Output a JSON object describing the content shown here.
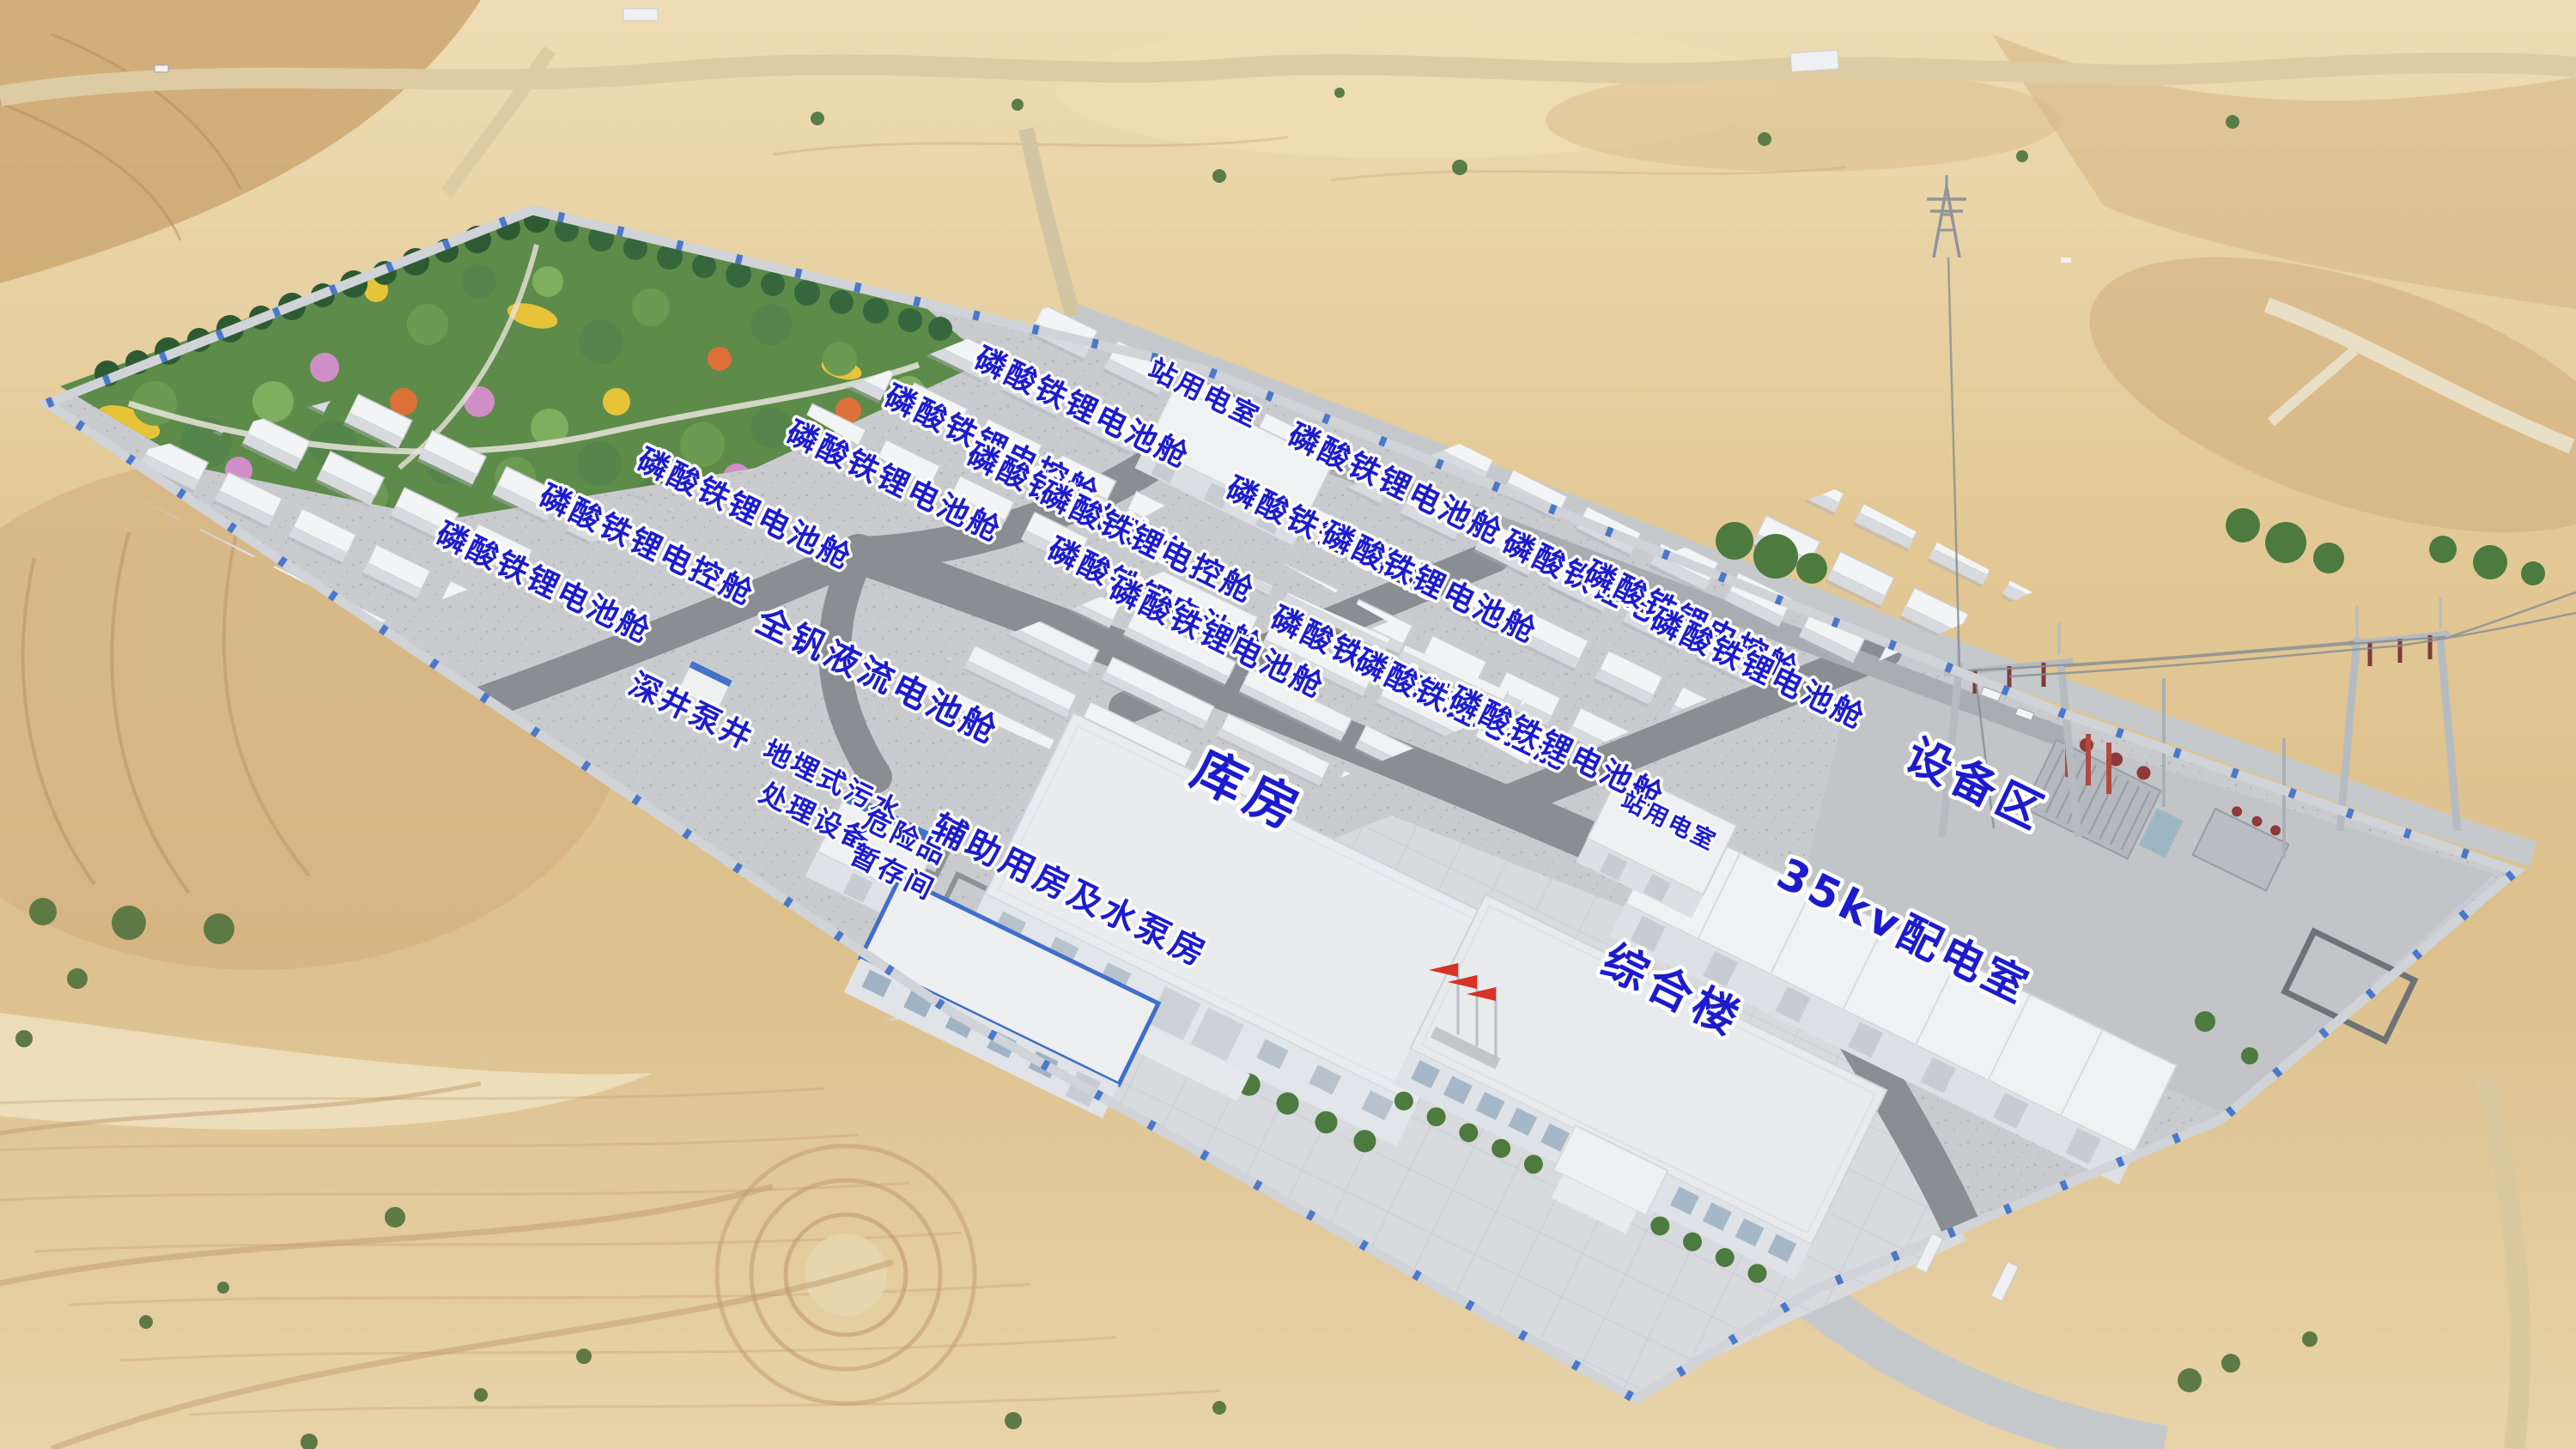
{
  "palette": {
    "label_blue": "#1c1ccd",
    "wall_blue": "#4273c9",
    "flag_red": "#d63226",
    "container_white": "#f3f4f6",
    "desert_sand": "#e3c996",
    "garden_green": "#55854a",
    "road_gray": "#8a8d92"
  },
  "labels": [
    {
      "text": "磷酸铁锂电池舱"
    },
    {
      "text": "磷酸铁锂电控舱"
    },
    {
      "text": "磷酸铁锂电池舱"
    },
    {
      "text": "磷酸铁锂电池舱"
    },
    {
      "text": "磷酸铁锂电控舱"
    },
    {
      "text": "磷酸铁锂电池舱"
    },
    {
      "text": "站用电室"
    },
    {
      "text": "磷酸铁锂电池舱"
    },
    {
      "text": "磷酸铁锂电控舱"
    },
    {
      "text": "磷酸铁锂电池舱"
    },
    {
      "text": "磷酸铁锂电池舱"
    },
    {
      "text": "磷酸铁锂电池舱"
    },
    {
      "text": "磷酸铁锂电控舱"
    },
    {
      "text": "磷酸铁锂电池舱"
    },
    {
      "text": "磷酸铁锂电池舱"
    },
    {
      "text": "磷酸铁锂电控舱"
    },
    {
      "text": "磷酸铁锂电池舱"
    },
    {
      "text": "磷酸铁锂电池舱"
    },
    {
      "text": "磷酸铁锂电控舱"
    },
    {
      "text": "磷酸铁锂电池舱"
    },
    {
      "text": "全钒液流电池舱"
    },
    {
      "text": "深井泵井"
    },
    {
      "text": "地埋式污水"
    },
    {
      "text": "处理设备"
    },
    {
      "text": "危险品"
    },
    {
      "text": "暂存间"
    },
    {
      "text": "辅助用房及水泵房"
    },
    {
      "text": "库房"
    },
    {
      "text": "综合楼"
    },
    {
      "text": "站用电室"
    },
    {
      "text": "35kv配电室"
    },
    {
      "text": "设备区"
    }
  ]
}
